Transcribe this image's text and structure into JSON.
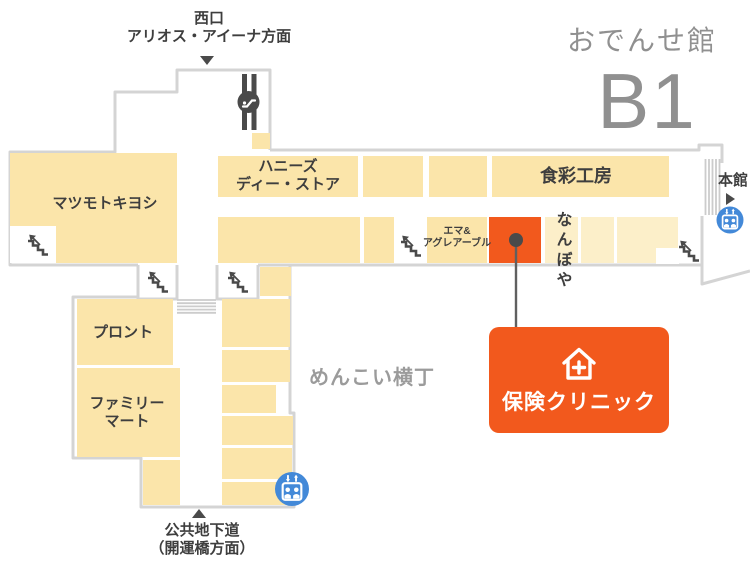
{
  "map_title": {
    "building_name": "おでんせ館",
    "floor": "B1"
  },
  "exits": {
    "west_exit_line1": "西口",
    "west_exit_line2": "アリオス・アイーナ方面",
    "main_building_label": "本館",
    "underground_line1": "公共地下道",
    "underground_line2": "（開運橋方面）"
  },
  "zones": {
    "menkoi_yokocho": "めんこい横丁"
  },
  "stores": {
    "matsumoto_kiyoshi": "マツモトキヨシ",
    "honeys_line1": "ハニーズ",
    "honeys_line2": "ディー・ストア",
    "shokusai_kobo": "食彩工房",
    "emma_line1": "エマ&",
    "emma_line2": "アグレアーブル",
    "nanboya": "なんぼや",
    "pronto": "プロント",
    "family_mart_line1": "ファミリー",
    "family_mart_line2": "マート"
  },
  "highlight_badge": {
    "label": "保険クリニック"
  },
  "icons": {
    "stairs": "stairs-icon",
    "escalator": "escalator-icon",
    "elevator": "elevator-icon",
    "clinic_house": "house-plus-icon",
    "arrow_down": "triangle-down-icon",
    "arrow_up": "triangle-up-icon",
    "arrow_right": "triangle-right-icon",
    "location_pin": "dot-connector-pin"
  },
  "colors": {
    "highlight_orange": "#F2591D",
    "room_cream": "#FBE5AA",
    "room_cream_pale": "#FCEFC9",
    "outline_gray": "#D4D4D4",
    "elevator_blue": "#4389D8",
    "icon_dark": "#4A4A4A",
    "text_dark": "#3E3E3E",
    "text_gray": "#909090"
  }
}
